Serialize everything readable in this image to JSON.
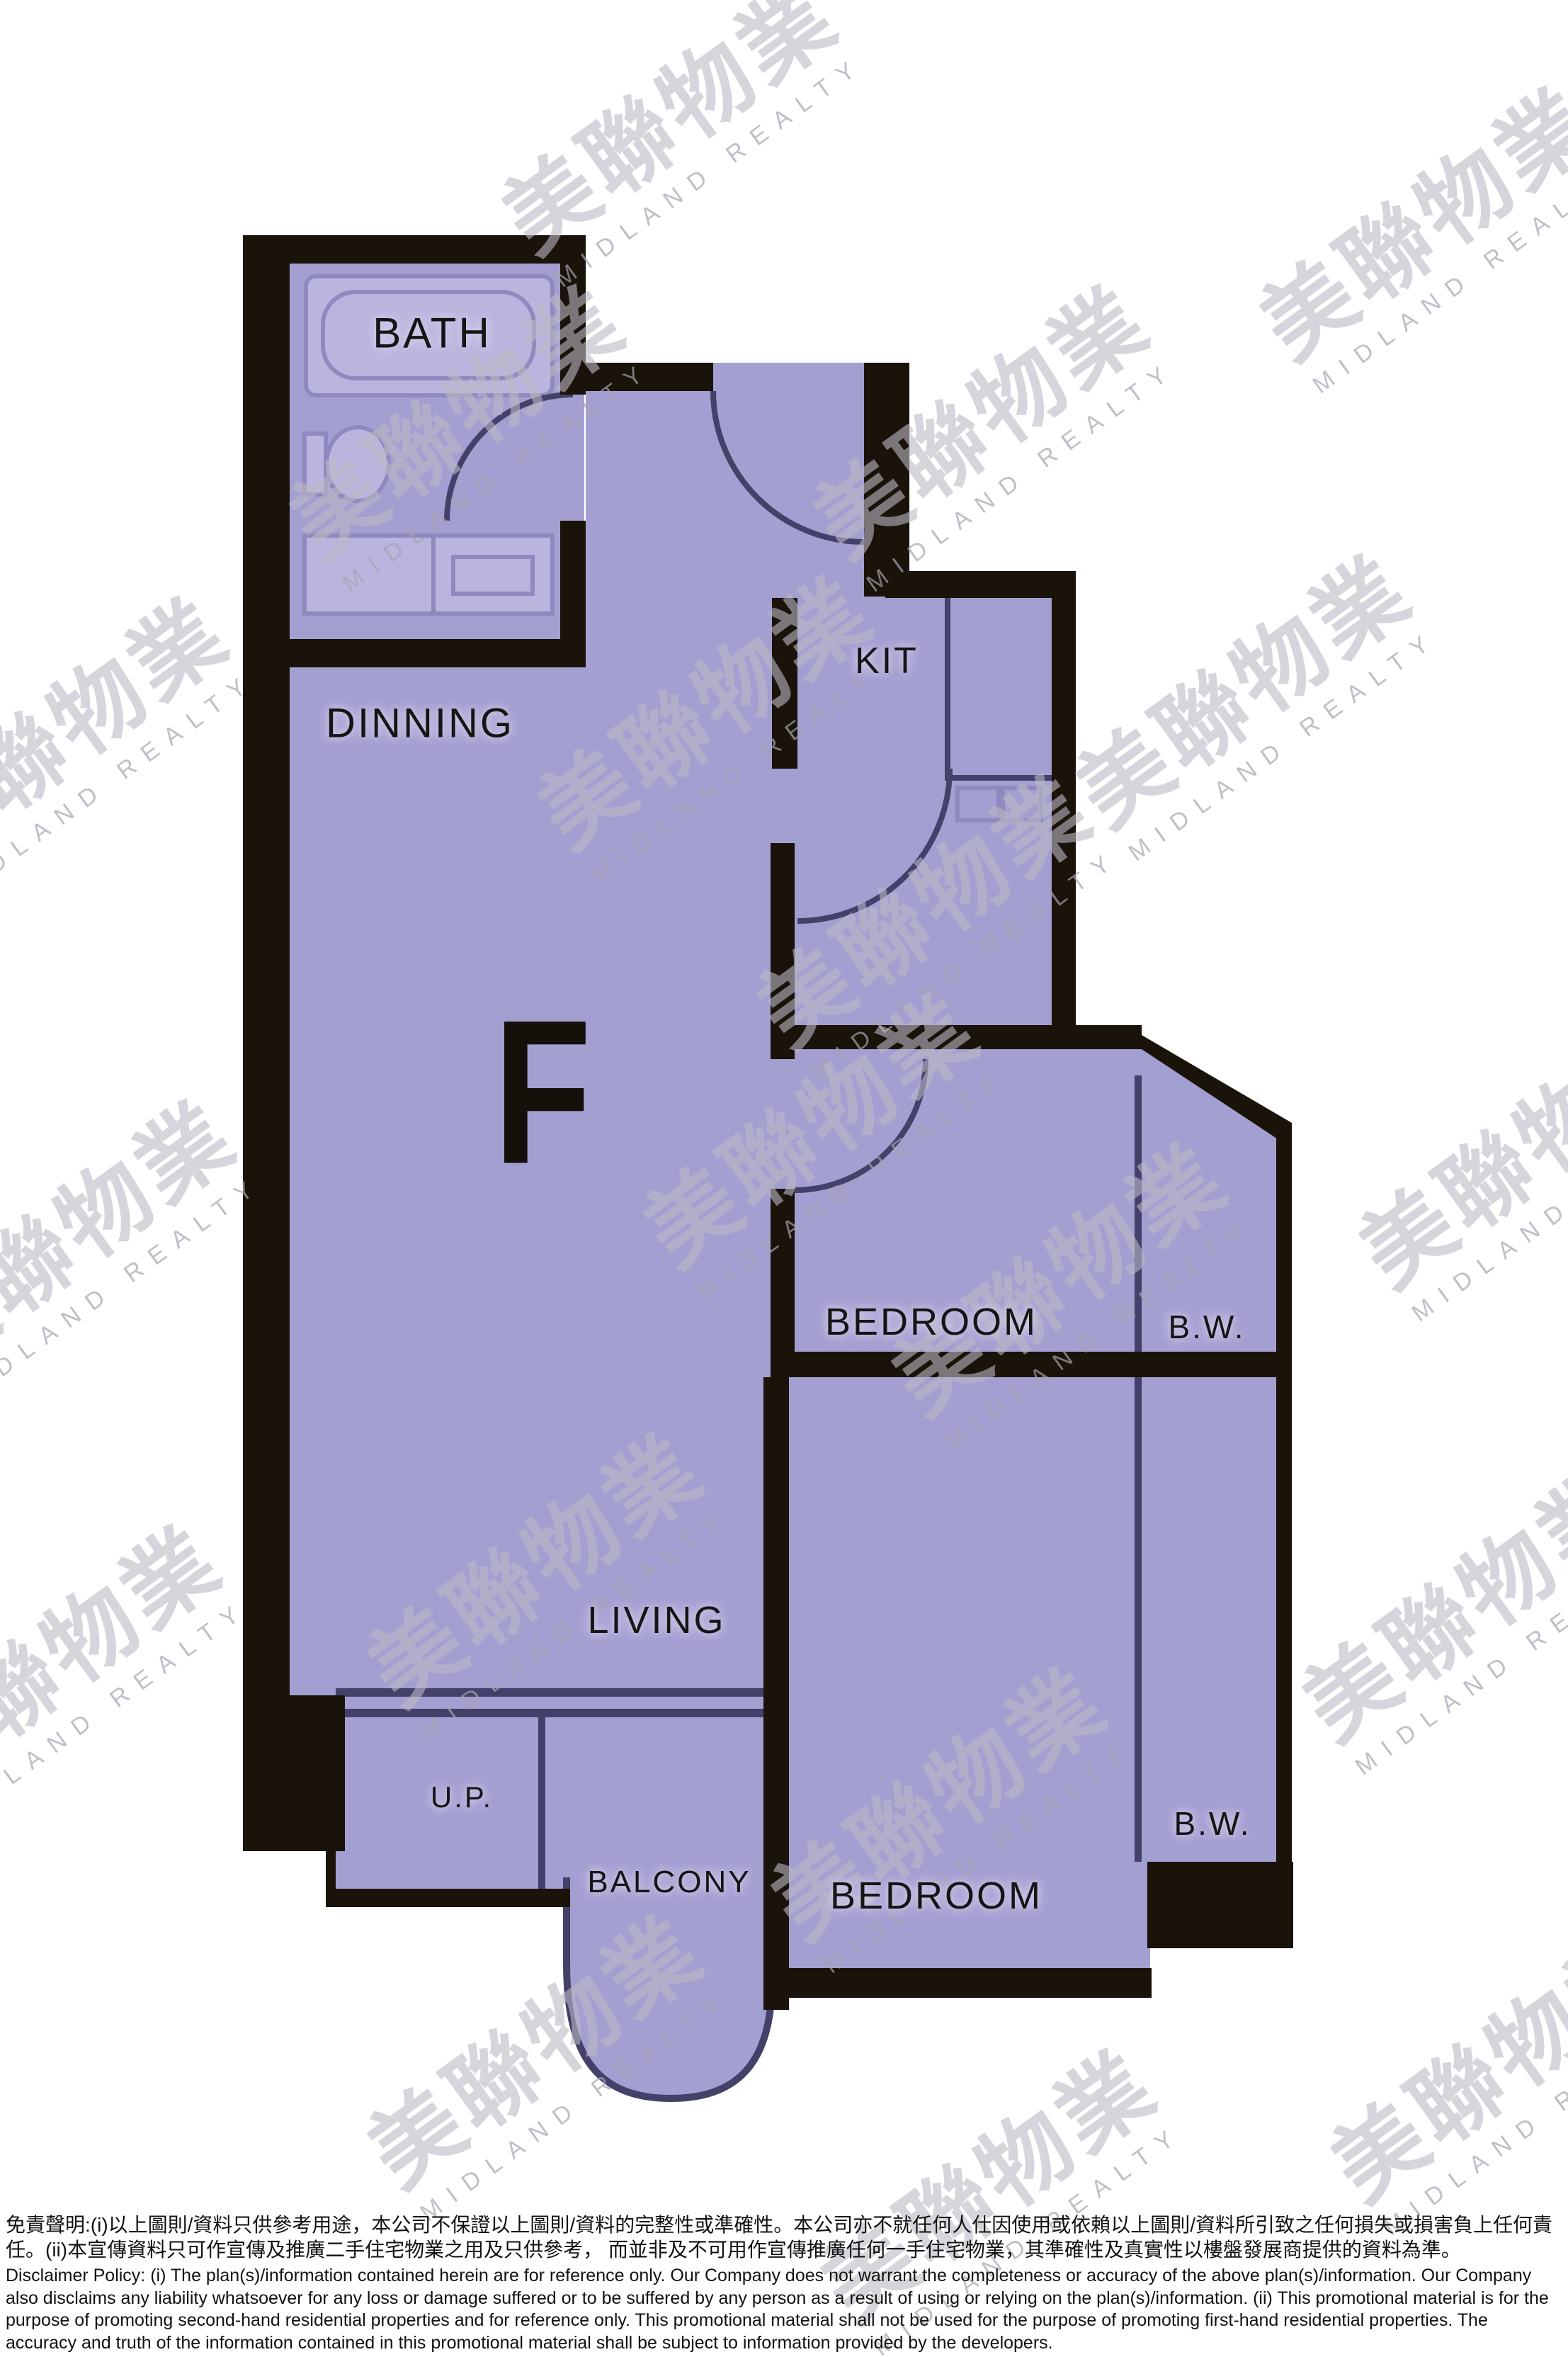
{
  "floor_plan": {
    "unit_label": "F",
    "labels": {
      "bath": "BATH",
      "kitchen": "KIT",
      "dining": "DINNING",
      "bedroom1": "BEDROOM",
      "bay_window1": "B.W.",
      "living": "LIVING",
      "utility_platform": "U.P.",
      "balcony": "BALCONY",
      "bedroom2": "BEDROOM",
      "bay_window2": "B.W."
    },
    "colors": {
      "background": "#ffffff",
      "floor_fill": "#a49fd1",
      "floor_fill_light": "#b9b5de",
      "fixture_stroke": "#8f8abd",
      "wall": "#191309",
      "thin_line": "#43406a",
      "label_text": "#151515",
      "watermark_zh": "rgba(186,185,197,0.60)",
      "watermark_en": "rgba(165,164,176,0.70)"
    }
  },
  "watermark": {
    "chinese_name": "美聯物業",
    "english_name": "MIDLAND REALTY"
  },
  "disclaimer": {
    "chinese": "免責聲明:(i)以上圖則/資料只供參考用途，本公司不保證以上圖則/資料的完整性或準確性。本公司亦不就任何人仕因使用或依賴以上圖則/資料所引致之任何損失或損害負上任何責任。(ii)本宣傳資料只可作宣傳及推廣二手住宅物業之用及只供參考， 而並非及不可用作宣傳推廣任何一手住宅物業，其準確性及真實性以樓盤發展商提供的資料為準。",
    "english": "Disclaimer Policy: (i) The plan(s)/information contained herein are for reference only. Our Company does not warrant the completeness or accuracy of the above plan(s)/information. Our Company also disclaims any liability whatsoever for any loss or damage suffered or to be suffered by any person as a result of using or relying on the plan(s)/information. (ii) This promotional material is for the purpose of promoting second-hand residential properties and for reference only. This promotional material shall not be used for the purpose of promoting first-hand residential properties. The accuracy and truth of the information contained in this promotional material shall be subject to information provided by the developers."
  }
}
